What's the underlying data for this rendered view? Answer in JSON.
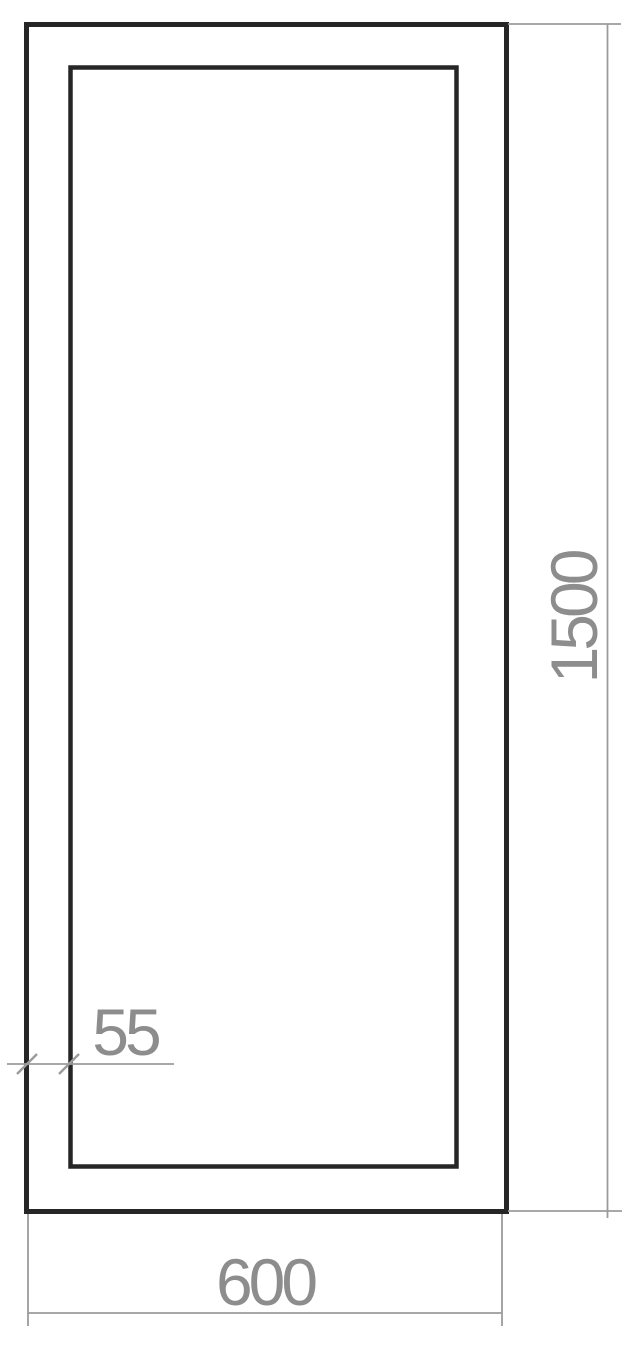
{
  "drawing": {
    "colors": {
      "background": "#ffffff",
      "outline": "#262626",
      "dimension_lines": "#9b9b9b",
      "dimension_text": "#8d8d8d"
    },
    "dimensions": {
      "overall_height": "1500",
      "overall_width": "600",
      "frame_thickness": "55"
    }
  }
}
